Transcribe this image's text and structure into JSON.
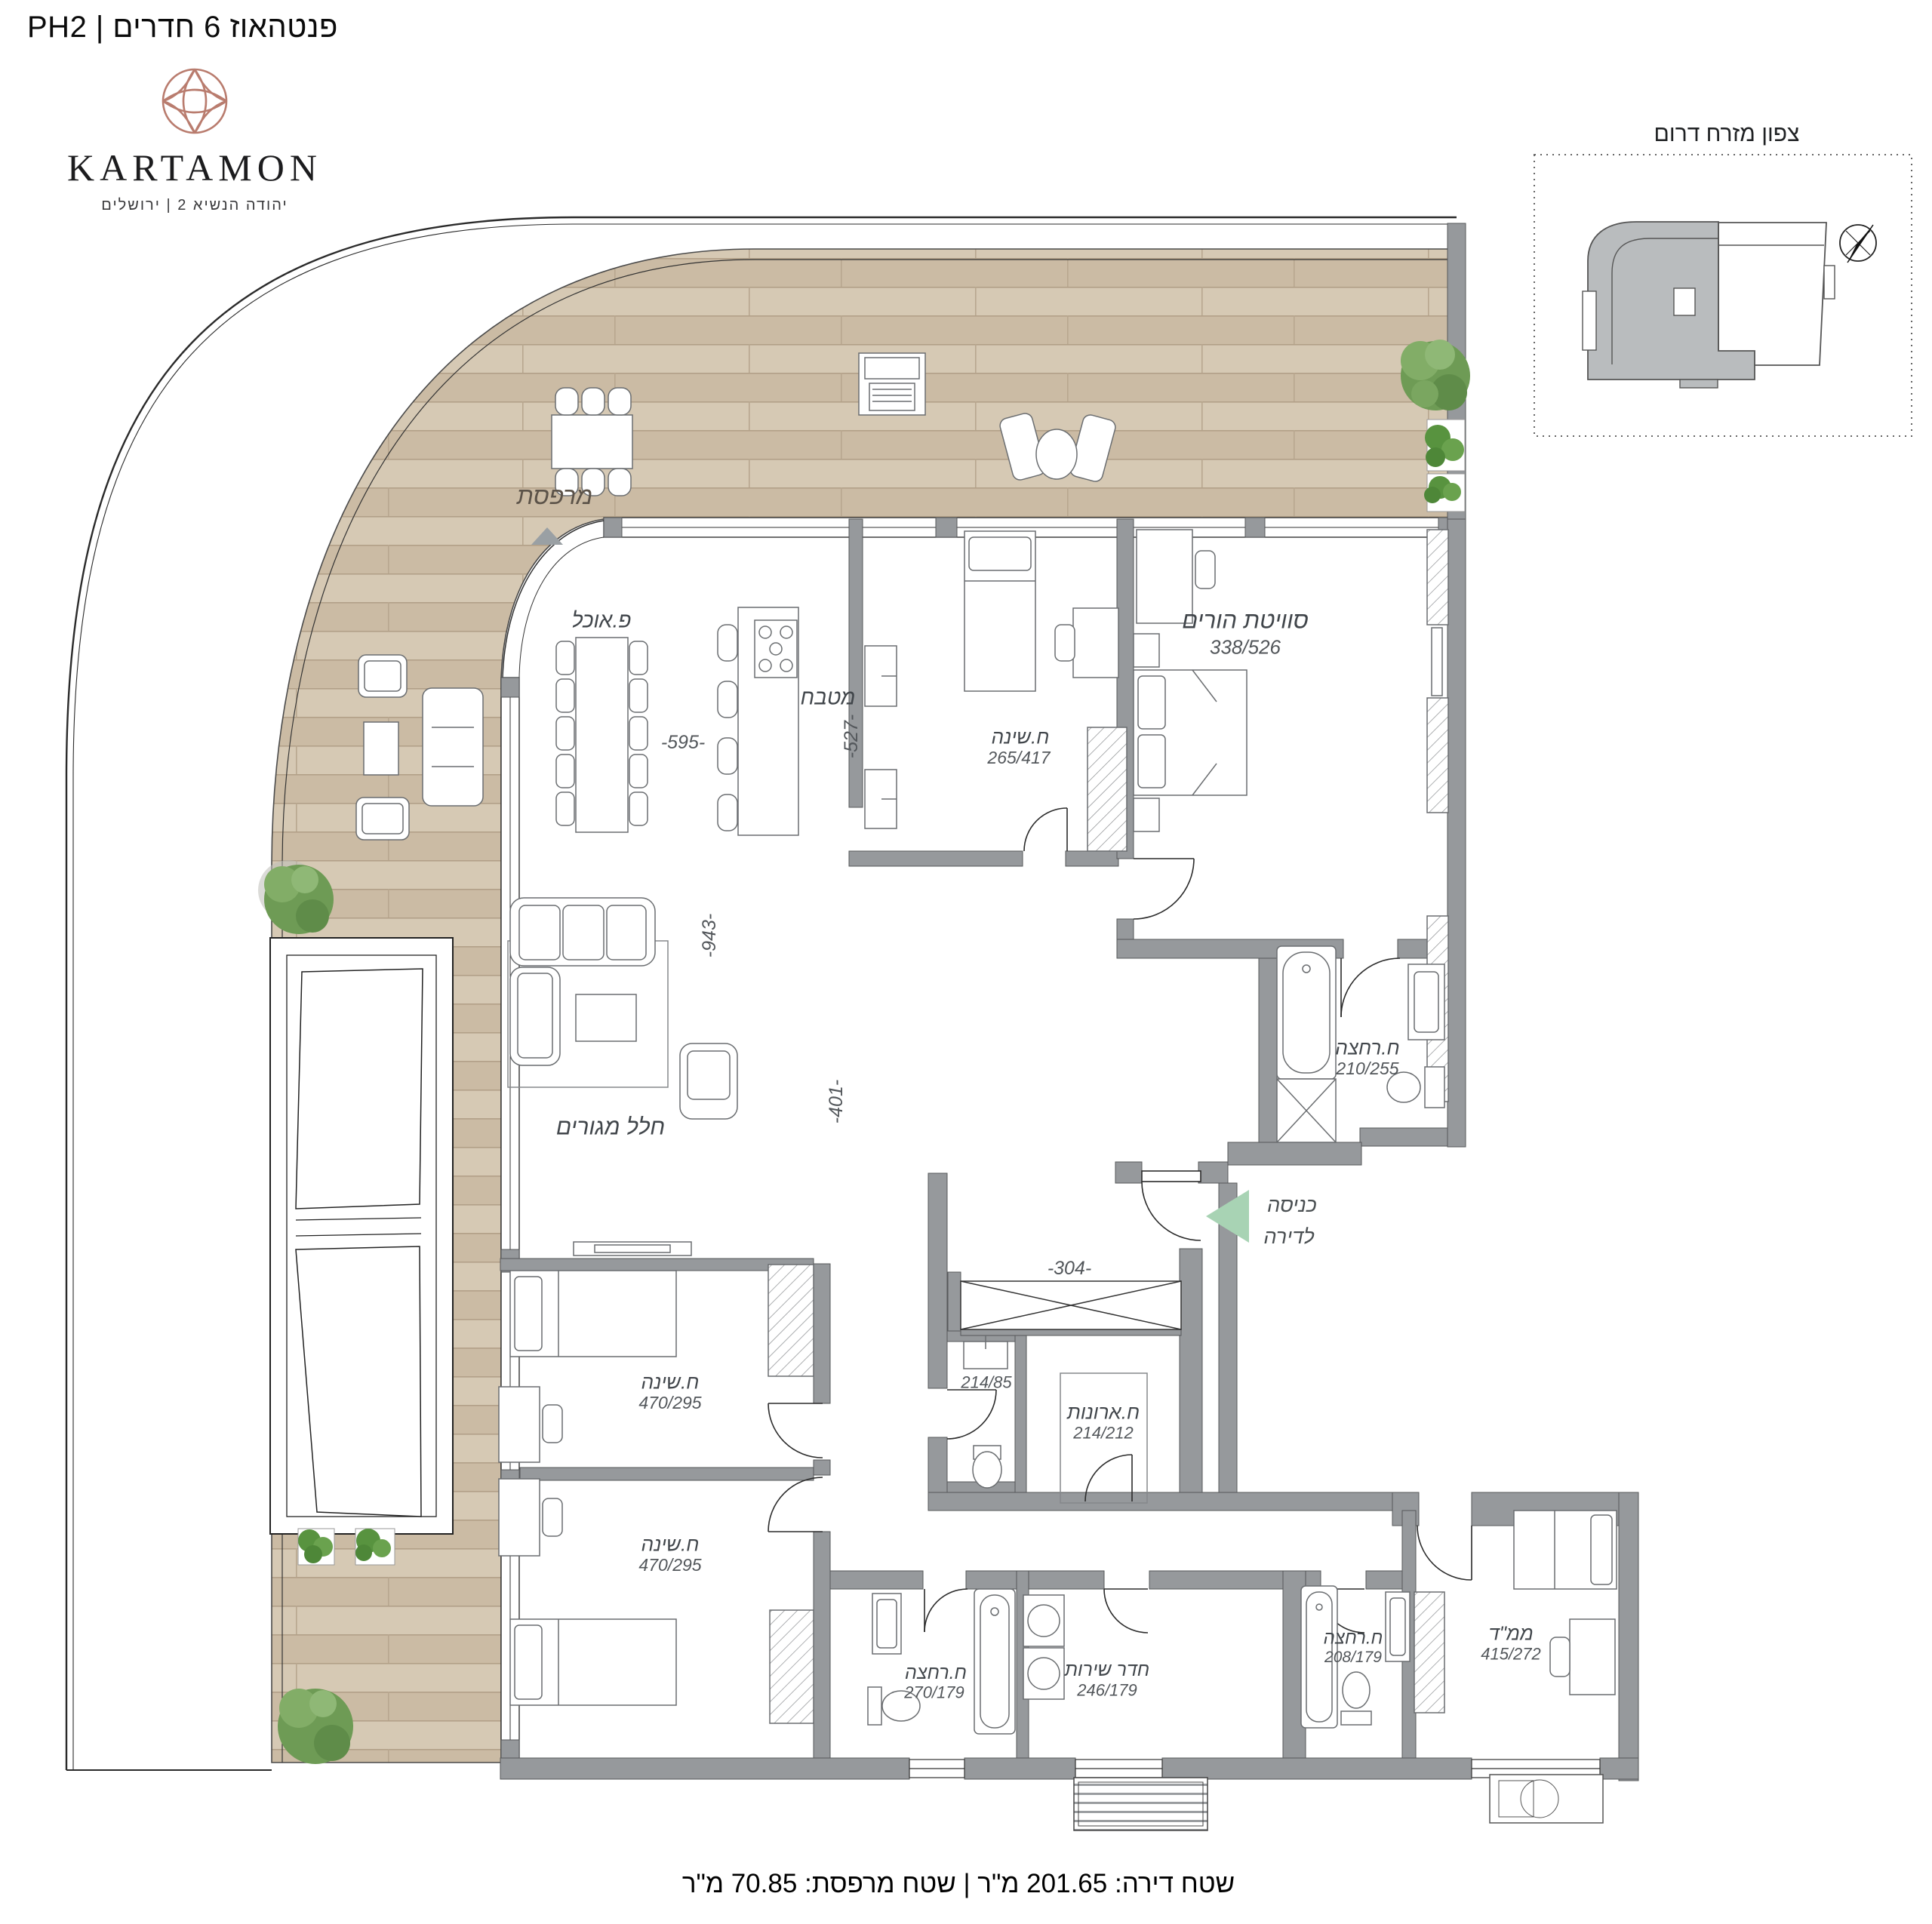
{
  "page": {
    "title": "פנטהאוז 6 חדרים | PH2"
  },
  "logo": {
    "brand": "KARTAMON",
    "tagline": "יהודה הנשיא 2  |  ירושלים"
  },
  "locator": {
    "title": "צפון מזרח דרום"
  },
  "rooms": {
    "balcony": {
      "name": "מרפסת"
    },
    "dining": {
      "name": "פ.אוכל"
    },
    "kitchen": {
      "name": "מטבח"
    },
    "bedroom1": {
      "name": "ח.שינה",
      "dims": "265/417"
    },
    "suite": {
      "name": "סוויטת הורים",
      "dims": "338/526"
    },
    "suite_bath": {
      "name": "ח.רחצה",
      "dims": "210/255"
    },
    "living": {
      "name": "חלל מגורים"
    },
    "entry": {
      "line1": "כניסה",
      "line2": "לדירה"
    },
    "wc": {
      "dims": "214/85"
    },
    "closet_room": {
      "name": "ח.ארונות",
      "dims": "214/212"
    },
    "bedroom2": {
      "name": "ח.שינה",
      "dims": "470/295"
    },
    "bedroom3": {
      "name": "ח.שינה",
      "dims": "470/295"
    },
    "bath2": {
      "name": "ח.רחצה",
      "dims": "270/179"
    },
    "service": {
      "name": "חדר שירות",
      "dims": "246/179"
    },
    "bath3": {
      "name": "ח.רחצה",
      "dims": "208/179"
    },
    "mamad": {
      "name": "ממ\"ד",
      "dims": "415/272"
    }
  },
  "dimensions": {
    "d595": "-595-",
    "d527": "-527-",
    "d943": "-943-",
    "d401": "-401-",
    "d304": "-304-"
  },
  "footer": {
    "area_text": "שטח דירה: 201.65 מ\"ר | שטח מרפסת: 70.85 מ\"ר"
  },
  "colors": {
    "wall": "#96999c",
    "wood": "#d2c4ae",
    "accent_logo": "#b97c6e",
    "entry_arrow": "#a8d3b4",
    "plant": "#6e9b55"
  }
}
